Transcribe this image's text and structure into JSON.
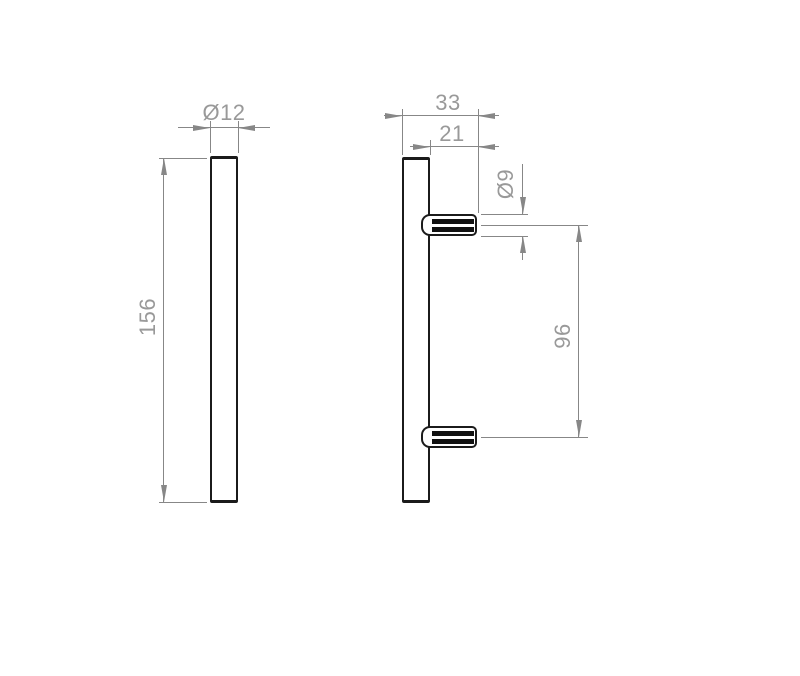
{
  "front_view": {
    "diameter_label": "Ø12",
    "length_label": "156"
  },
  "side_view": {
    "depth_label": "33",
    "stud_length_label": "21",
    "stud_diameter_label": "Ø9",
    "centres_label": "96"
  },
  "colors": {
    "outline": "#1b1b1b",
    "dimension_line": "#878787",
    "dimension_text": "#999999",
    "background": "#ffffff"
  }
}
